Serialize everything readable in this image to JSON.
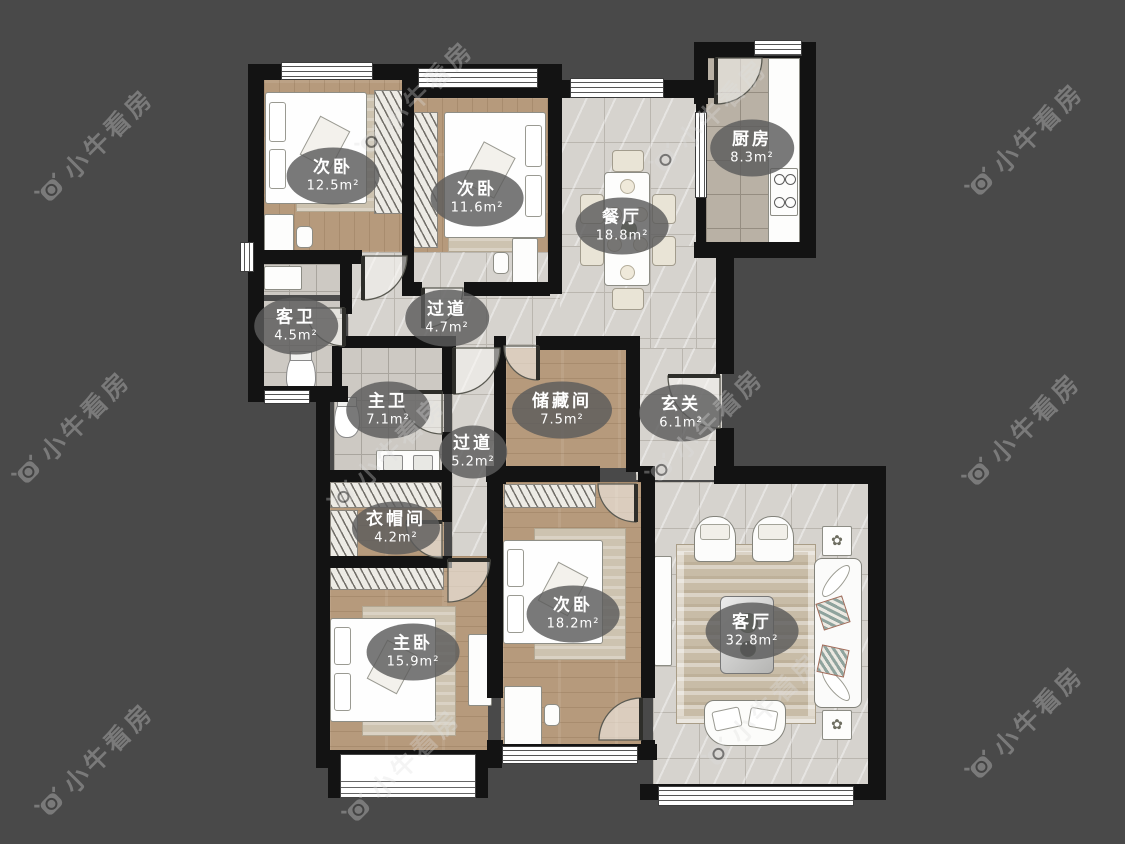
{
  "brand": {
    "watermark_text": "小牛看房"
  },
  "rooms": [
    {
      "id": "bedroom-a",
      "name": "次卧",
      "area": "12.5m²"
    },
    {
      "id": "bedroom-b",
      "name": "次卧",
      "area": "11.6m²"
    },
    {
      "id": "dining",
      "name": "餐厅",
      "area": "18.8m²"
    },
    {
      "id": "kitchen",
      "name": "厨房",
      "area": "8.3m²"
    },
    {
      "id": "guest-bath",
      "name": "客卫",
      "area": "4.5m²"
    },
    {
      "id": "hallway-a",
      "name": "过道",
      "area": "4.7m²"
    },
    {
      "id": "master-bath",
      "name": "主卫",
      "area": "7.1m²"
    },
    {
      "id": "storage-room",
      "name": "储藏间",
      "area": "7.5m²"
    },
    {
      "id": "foyer",
      "name": "玄关",
      "area": "6.1m²"
    },
    {
      "id": "hallway-b",
      "name": "过道",
      "area": "5.2m²"
    },
    {
      "id": "cloakroom",
      "name": "衣帽间",
      "area": "4.2m²"
    },
    {
      "id": "master-bedroom",
      "name": "主卧",
      "area": "15.9m²"
    },
    {
      "id": "bedroom-c",
      "name": "次卧",
      "area": "18.2m²"
    },
    {
      "id": "living-room",
      "name": "客厅",
      "area": "32.8m²"
    }
  ],
  "colors": {
    "background": "#494949",
    "wall": "#131313",
    "wood_floor": "#b69a7c",
    "tile_floor": "#d6d3ce",
    "label_bubble": "rgba(92,92,92,0.82)",
    "watermark": "rgba(222,222,222,0.33)"
  }
}
